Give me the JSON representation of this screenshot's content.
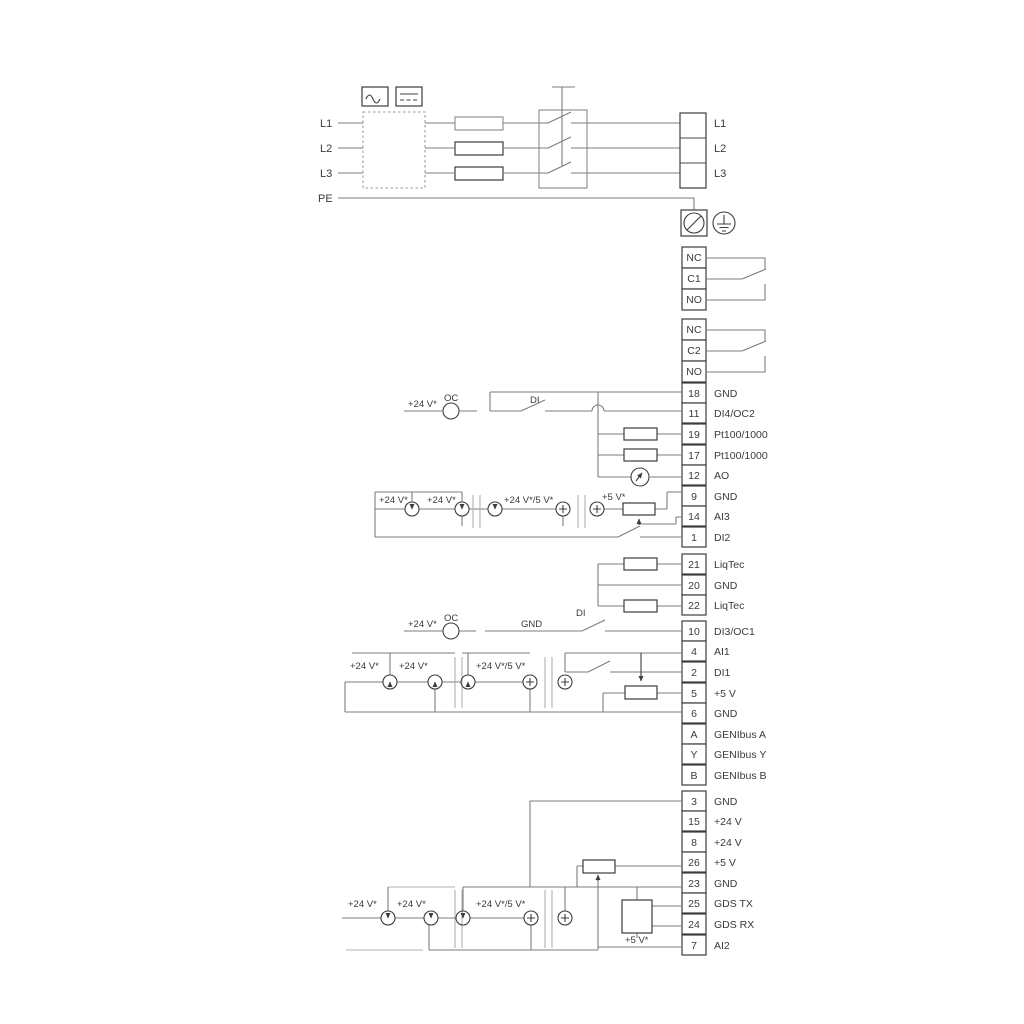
{
  "diagram": {
    "power_input": {
      "left_labels": [
        "L1",
        "L2",
        "L3"
      ],
      "pe_label": "PE",
      "output_terminals": [
        "L1",
        "L2",
        "L3"
      ]
    },
    "relays": [
      {
        "contacts": [
          "NC",
          "C1",
          "NO"
        ]
      },
      {
        "contacts": [
          "NC",
          "C2",
          "NO"
        ]
      }
    ],
    "terminal_groups": [
      {
        "rows": [
          {
            "n": "18",
            "l": "GND"
          },
          {
            "n": "11",
            "l": "DI4/OC2"
          },
          {
            "n": "19",
            "l": "Pt100/1000"
          },
          {
            "n": "17",
            "l": "Pt100/1000"
          },
          {
            "n": "12",
            "l": "AO"
          },
          {
            "n": "9",
            "l": "GND"
          },
          {
            "n": "14",
            "l": "AI3"
          },
          {
            "n": "1",
            "l": "DI2"
          }
        ]
      },
      {
        "rows": [
          {
            "n": "21",
            "l": "LiqTec"
          },
          {
            "n": "20",
            "l": "GND"
          },
          {
            "n": "22",
            "l": "LiqTec"
          }
        ]
      },
      {
        "rows": [
          {
            "n": "10",
            "l": "DI3/OC1"
          },
          {
            "n": "4",
            "l": "AI1"
          },
          {
            "n": "2",
            "l": "DI1"
          },
          {
            "n": "5",
            "l": "+5 V"
          },
          {
            "n": "6",
            "l": "GND"
          },
          {
            "n": "A",
            "l": "GENIbus A"
          },
          {
            "n": "Y",
            "l": "GENIbus Y"
          },
          {
            "n": "B",
            "l": "GENIbus B"
          }
        ]
      },
      {
        "rows": [
          {
            "n": "3",
            "l": "GND"
          },
          {
            "n": "15",
            "l": "+24 V"
          },
          {
            "n": "8",
            "l": "+24 V"
          },
          {
            "n": "26",
            "l": "+5 V"
          },
          {
            "n": "23",
            "l": "GND"
          },
          {
            "n": "25",
            "l": "GDS TX"
          },
          {
            "n": "24",
            "l": "GDS RX"
          },
          {
            "n": "7",
            "l": "AI2"
          }
        ]
      }
    ],
    "labels": {
      "v24": "+24 V*",
      "oc": "OC",
      "di": "DI",
      "gnd": "GND",
      "v24_5": "+24 V*/5 V*",
      "v5": "+5 V*"
    },
    "colors": {
      "wire_gray": "#7d7d7d",
      "wire_dark": "#4a4a4a",
      "outline": "#3d3d3d",
      "background": "#ffffff"
    }
  }
}
